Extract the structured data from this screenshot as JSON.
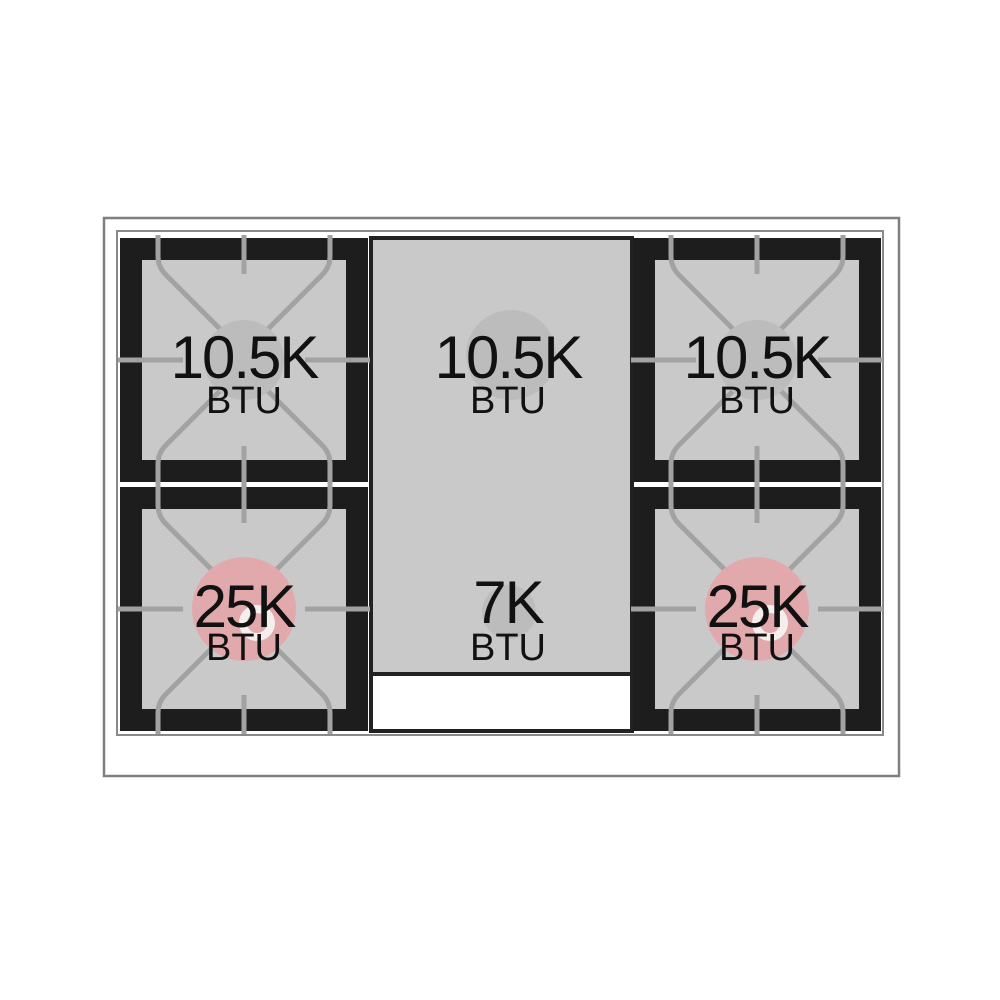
{
  "diagram_title": "Gas range cooktop burner BTU diagram",
  "burners": {
    "top_left": {
      "value": "10.5K",
      "unit": "BTU",
      "type": "standard"
    },
    "top_center": {
      "value": "10.5K",
      "unit": "BTU",
      "type": "standard"
    },
    "top_right": {
      "value": "10.5K",
      "unit": "BTU",
      "type": "standard"
    },
    "bottom_left": {
      "value": "25K",
      "unit": "BTU",
      "type": "high-power"
    },
    "bottom_center": {
      "value": "7K",
      "unit": "BTU",
      "type": "standard"
    },
    "bottom_right": {
      "value": "25K",
      "unit": "BTU",
      "type": "high-power"
    }
  },
  "colors": {
    "burner_standard": "#bcbcbc",
    "burner_high_power": "#e2a9ad",
    "burner_cap_ring": "#f4eeed",
    "module_black": "#1d1d1d",
    "surface_gray": "#c9c9c9",
    "grate_line": "#a2a2a2",
    "frame_line": "#7f7f7f",
    "label_text": "#111111",
    "background": "#ffffff"
  }
}
